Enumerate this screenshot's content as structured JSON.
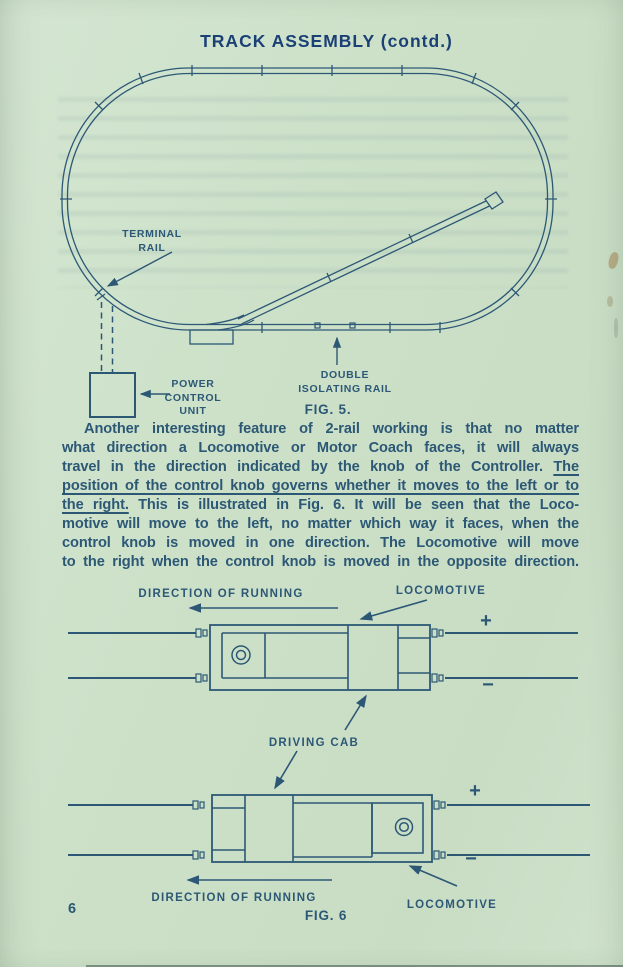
{
  "colors": {
    "paper": "#cde1c9",
    "ink": "#2c5876",
    "title_ink": "#1b4076"
  },
  "header": {
    "title": "TRACK ASSEMBLY (contd.)"
  },
  "fig5": {
    "caption": "FIG. 5.",
    "terminal_rail_line1": "TERMINAL",
    "terminal_rail_line2": "RAIL",
    "power_line1": "POWER",
    "power_line2": "CONTROL",
    "power_line3": "UNIT",
    "isolating_line1": "DOUBLE",
    "isolating_line2": "ISOLATING RAIL"
  },
  "paragraph": {
    "lines": [
      {
        "indent": true,
        "segments": [
          {
            "t": "Another interesting feature of 2-rail working is that no matter",
            "u": false
          }
        ]
      },
      {
        "segments": [
          {
            "t": "what direction a Locomotive or Motor Coach faces, it will always",
            "u": false
          }
        ]
      },
      {
        "segments": [
          {
            "t": "travel in the direction indicated by the knob of the Controller. ",
            "u": false
          },
          {
            "t": "The",
            "u": true
          }
        ]
      },
      {
        "segments": [
          {
            "t": "position of the control knob governs whether it moves to the left or to",
            "u": true
          }
        ]
      },
      {
        "segments": [
          {
            "t": "the right.",
            "u": true
          },
          {
            "t": " This is illustrated in Fig. 6.  It will be seen that the Loco-",
            "u": false
          }
        ]
      },
      {
        "segments": [
          {
            "t": "motive will move to the left, no matter which way it faces, when the",
            "u": false
          }
        ]
      },
      {
        "segments": [
          {
            "t": "control knob is moved in one direction.  The Locomotive will move",
            "u": false
          }
        ]
      },
      {
        "segments": [
          {
            "t": "to the right when the control knob is moved in the opposite direction.",
            "u": false
          }
        ]
      }
    ]
  },
  "fig6": {
    "caption": "FIG. 6",
    "driving_cab_label": "DRIVING CAB",
    "top": {
      "direction_label": "DIRECTION OF RUNNING",
      "locomotive_label": "LOCOMOTIVE",
      "plus": "+",
      "minus": "−"
    },
    "bottom": {
      "direction_label": "DIRECTION OF RUNNING",
      "locomotive_label": "LOCOMOTIVE",
      "plus": "+",
      "minus": "−"
    }
  },
  "footer": {
    "page_number": "6"
  }
}
